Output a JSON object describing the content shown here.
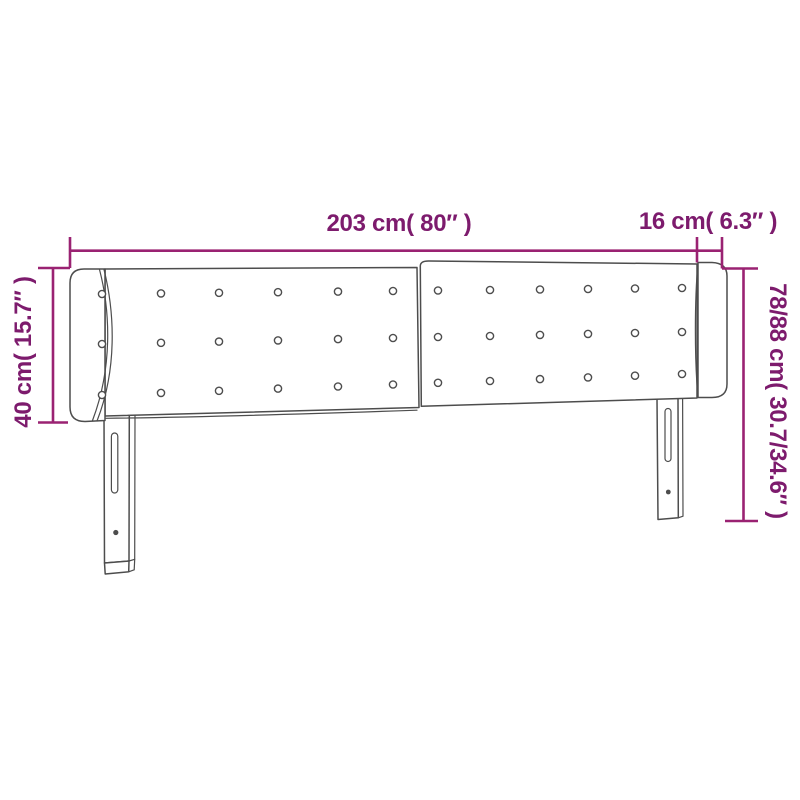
{
  "diagram": {
    "labels": {
      "width": "203 cm( 80″ )",
      "side_depth": "16 cm( 6.3″ )",
      "left_height": "40 cm( 15.7″ )",
      "right_height": "78/88 cm( 30.7/34.6″ )"
    }
  },
  "headboard": {
    "button_rows": 3,
    "button_cols": 12,
    "leg_count": 2
  },
  "colors": {
    "dimension_line": "#9A2272",
    "dimension_text": "#7D1B6D",
    "drawing_outline": "#4D4D4D",
    "background": "#FFFFFF"
  }
}
